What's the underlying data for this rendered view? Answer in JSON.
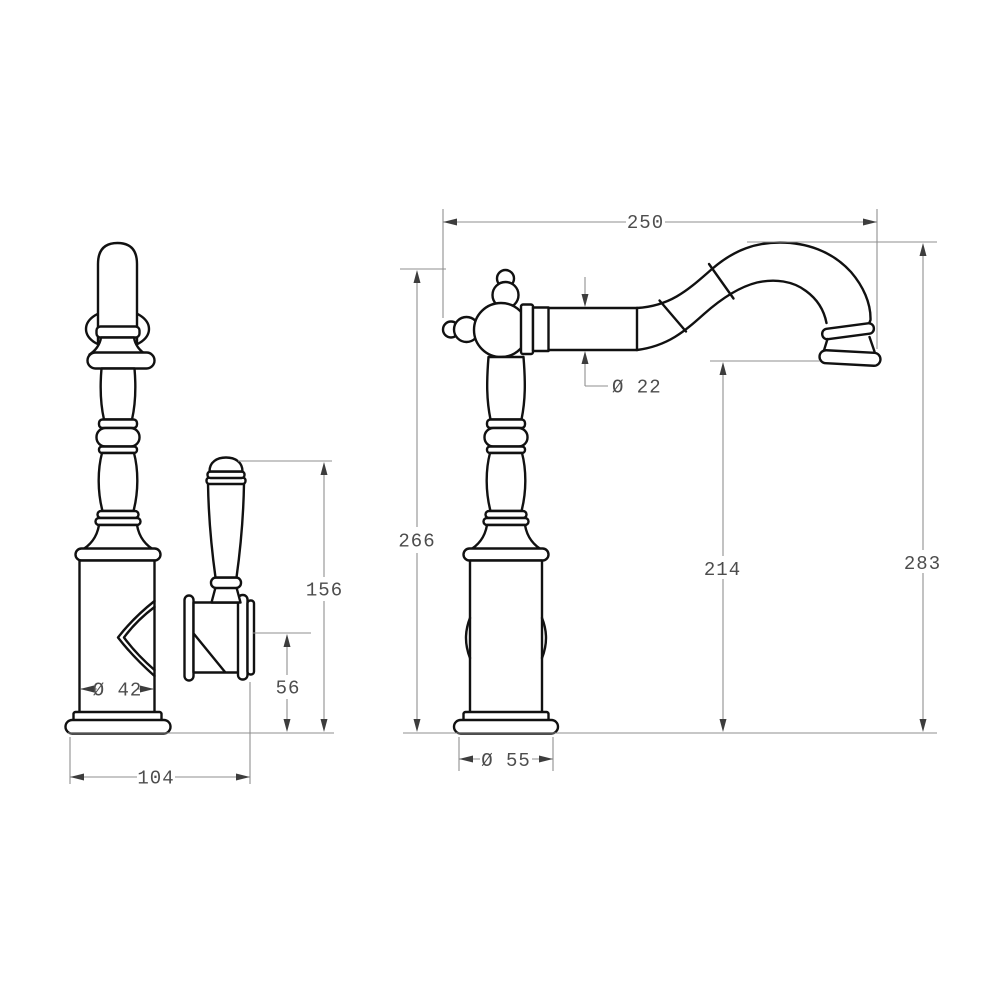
{
  "title": "Kitchen mixer tap technical drawing — two orthographic views with millimetre dimensions",
  "views": {
    "left": "side view (handle and valve body)",
    "right": "front view (swivel spout)"
  },
  "colors": {
    "background": "#ffffff",
    "outline": "#111111",
    "dimension_line": "#8f8f8f",
    "dimension_text": "#4d4d4d",
    "arrowhead": "#3d3d3d"
  },
  "dimensions": [
    {
      "id": "spout-reach",
      "value": "250",
      "orientation": "horizontal",
      "view": "front"
    },
    {
      "id": "spout-tube-diameter",
      "value": "Ø 22",
      "orientation": "leader",
      "view": "front"
    },
    {
      "id": "height-to-hub-top",
      "value": "266",
      "orientation": "vertical",
      "view": "front"
    },
    {
      "id": "outlet-height",
      "value": "214",
      "orientation": "vertical",
      "view": "front"
    },
    {
      "id": "overall-height",
      "value": "283",
      "orientation": "vertical",
      "view": "front"
    },
    {
      "id": "handle-top-height",
      "value": "156",
      "orientation": "vertical",
      "view": "side"
    },
    {
      "id": "valve-center-height",
      "value": "56",
      "orientation": "vertical",
      "view": "side"
    },
    {
      "id": "body-diameter",
      "value": "Ø 42",
      "orientation": "horizontal",
      "view": "side"
    },
    {
      "id": "overall-depth",
      "value": "104",
      "orientation": "horizontal",
      "view": "side"
    },
    {
      "id": "base-diameter",
      "value": "Ø 55",
      "orientation": "horizontal",
      "view": "front"
    }
  ]
}
